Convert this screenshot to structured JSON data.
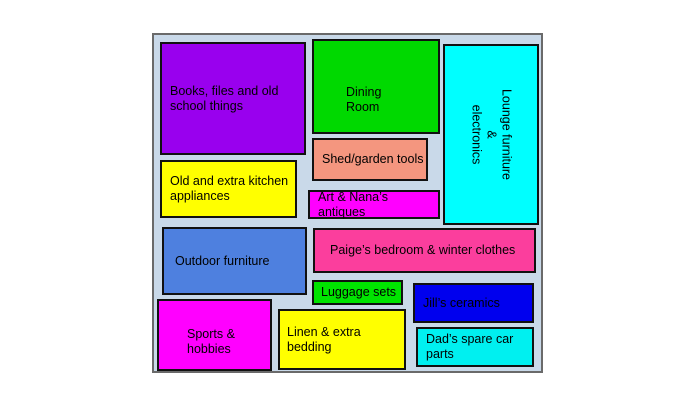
{
  "diagram": {
    "title": "Storage layout plan",
    "background_color": "#c9d9e9",
    "outer_border_color": "#6a6a6a",
    "block_border_color": "#111111",
    "text_color": "#000000"
  },
  "rooms": [
    {
      "id": "books",
      "label": "Books, files and old\nschool things",
      "color": "#9900ee"
    },
    {
      "id": "dining",
      "label": "Dining\nRoom",
      "color": "#00d900"
    },
    {
      "id": "shed",
      "label": "Shed/garden tools",
      "color": "#f4967f"
    },
    {
      "id": "lounge",
      "label": "Lounge furniture &\nelectronics",
      "color": "#00ffff",
      "rotated": true
    },
    {
      "id": "kitchen",
      "label": "Old and extra kitchen\nappliances",
      "color": "#ffff00"
    },
    {
      "id": "art",
      "label": "Art & Nana’s\nantiques",
      "color": "#ff00ff"
    },
    {
      "id": "outdoor",
      "label": "Outdoor furniture",
      "color": "#4e80df"
    },
    {
      "id": "paige",
      "label": "Paige’s bedroom & winter clothes",
      "color": "#fb3e9d"
    },
    {
      "id": "luggage",
      "label": "Luggage sets",
      "color": "#00e400"
    },
    {
      "id": "sports",
      "label": "Sports &\nhobbies",
      "color": "#ff00ff"
    },
    {
      "id": "linen",
      "label": "Linen & extra\nbedding",
      "color": "#ffff00"
    },
    {
      "id": "jill",
      "label": "Jill’s ceramics",
      "color": "#0000ee"
    },
    {
      "id": "dad",
      "label": "Dad’s spare car\nparts",
      "color": "#00f0f0"
    }
  ]
}
